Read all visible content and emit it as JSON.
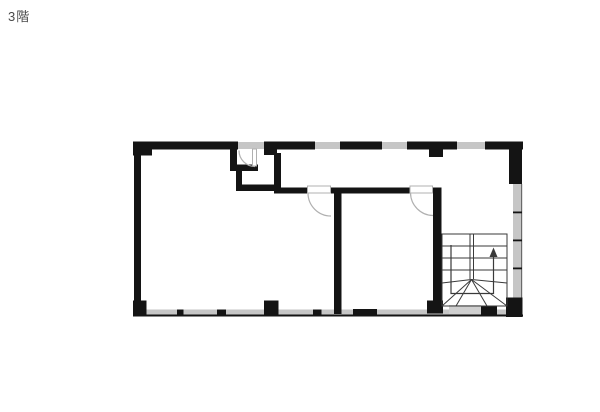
{
  "page": {
    "background": "#ffffff"
  },
  "floor_plan": {
    "label": "3階",
    "label_color": "#4a4a4a",
    "colors": {
      "wall": "#141414",
      "window": "#c6c6c6",
      "door": "#b0b0b0",
      "stair": "#3a3a3a"
    },
    "staircase": {
      "arrow_icon": "up-arrow",
      "direction": "up",
      "straight_treads": 3,
      "winder_fan_lines": 6
    }
  }
}
